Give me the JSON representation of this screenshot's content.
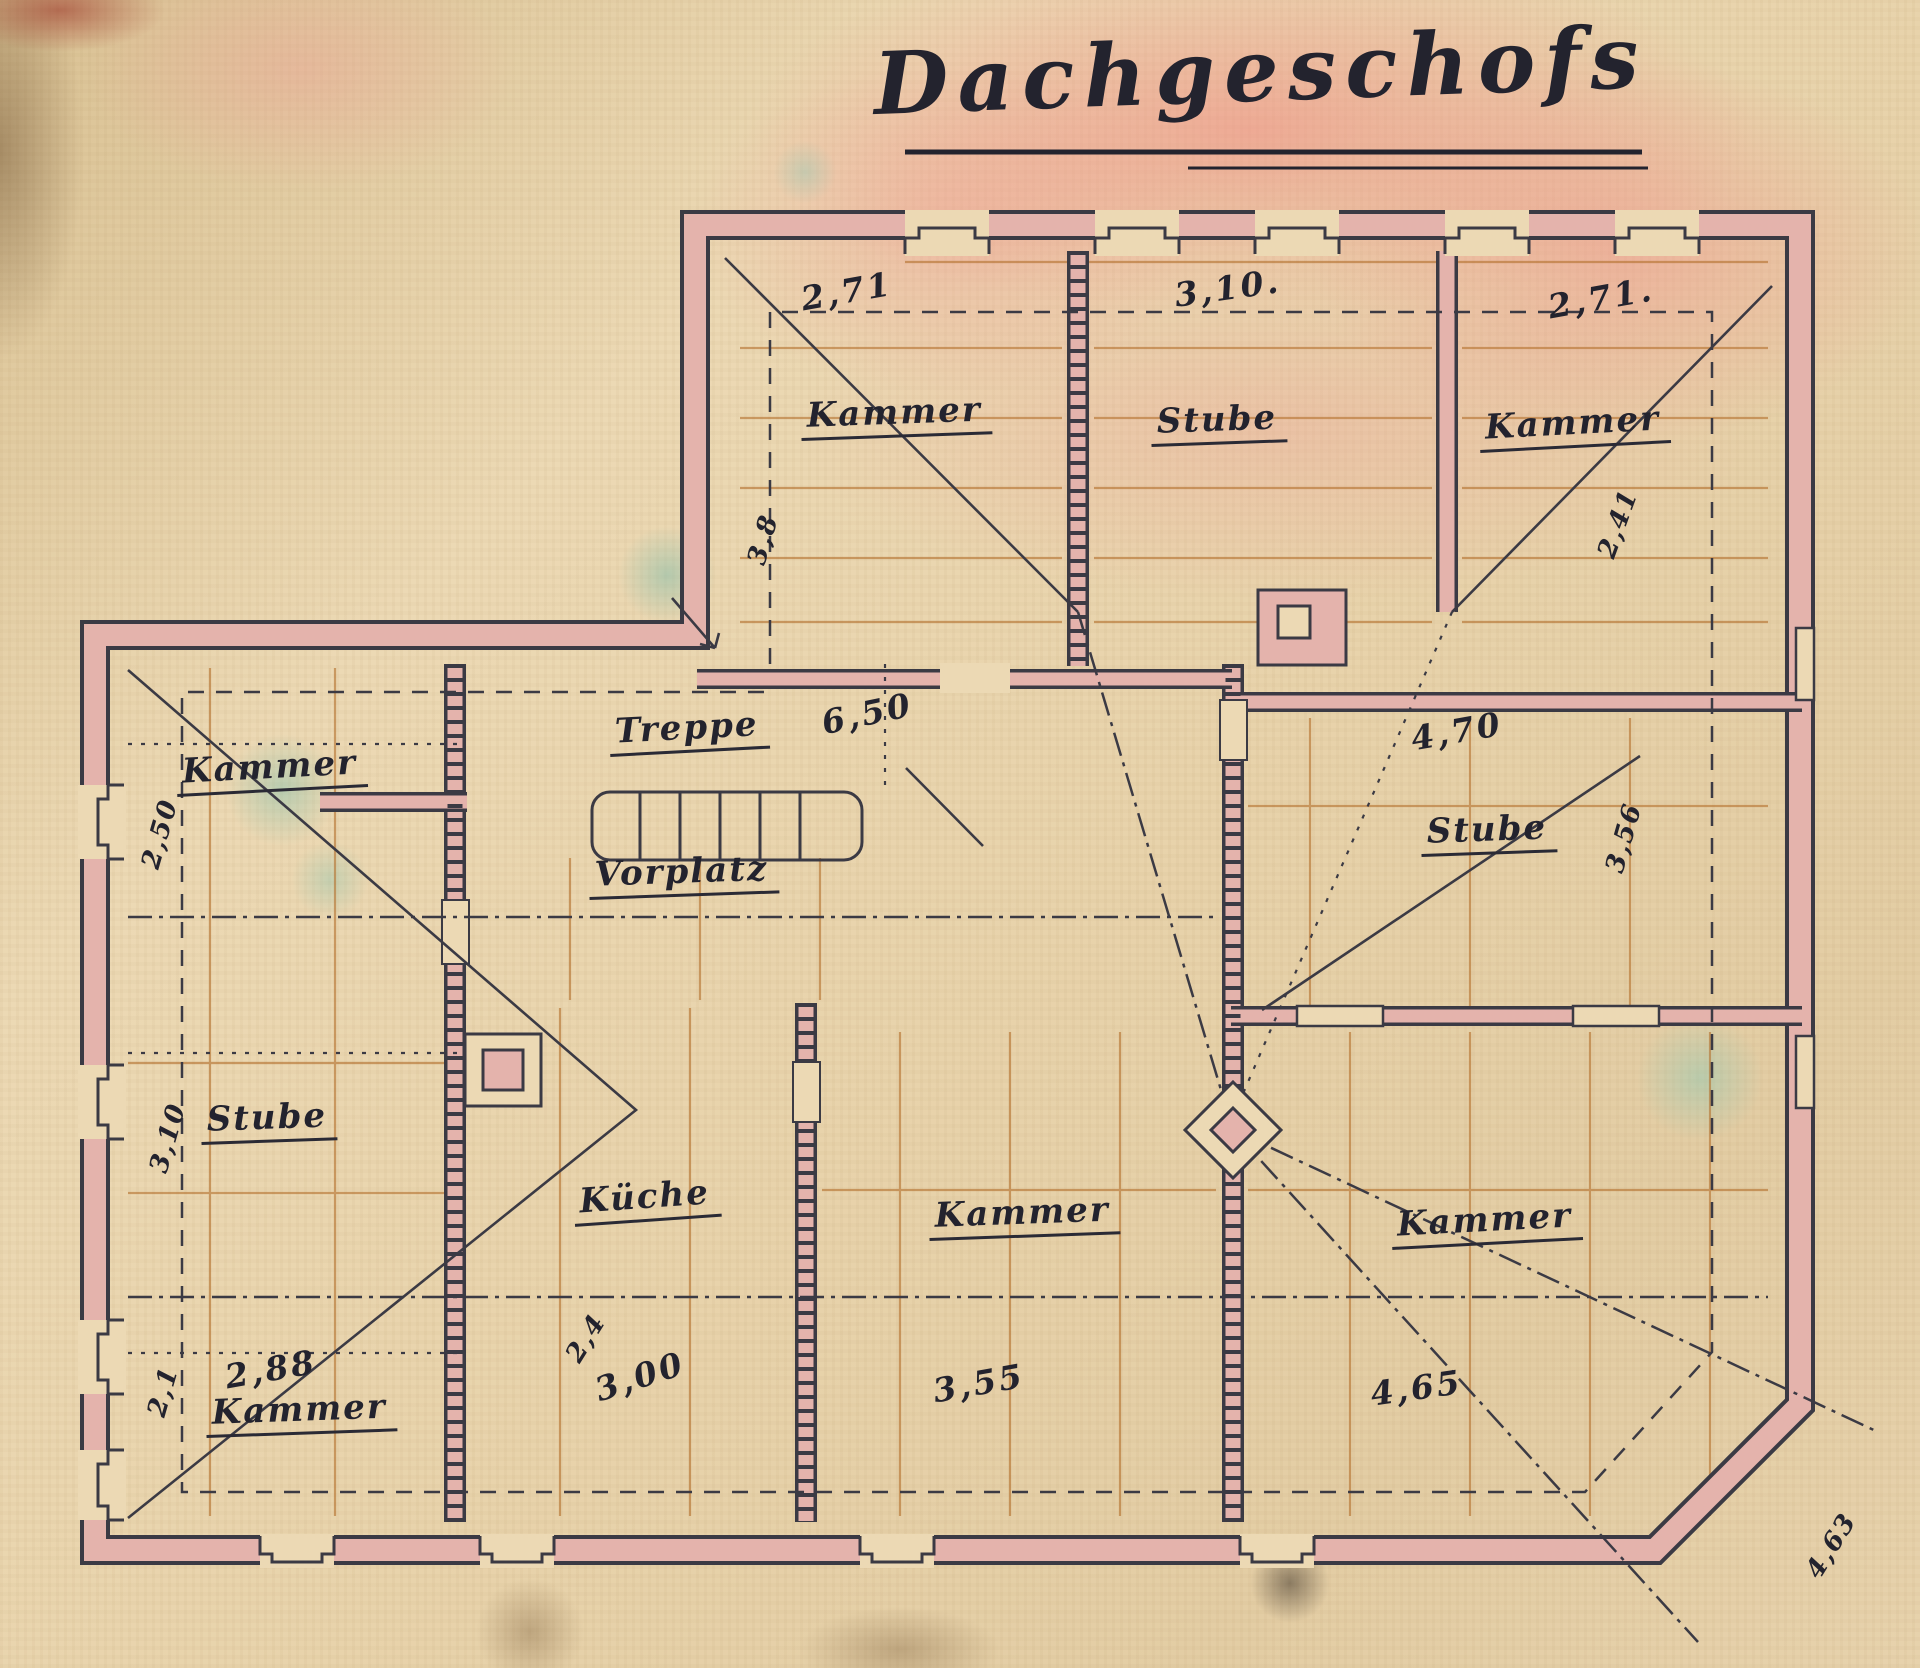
{
  "title": "Dachgeschofs",
  "rooms": {
    "upper_left": {
      "name": "Kammer",
      "width": "2,71",
      "depth": "3,8"
    },
    "upper_middle": {
      "name": "Stube",
      "width": "3,10."
    },
    "upper_right": {
      "name": "Kammer",
      "width": "2,71.",
      "depth": "2,41"
    },
    "right_stube": {
      "name": "Stube",
      "width": "4,70",
      "depth": "3,56"
    },
    "stair_hall": {
      "name": "Treppe",
      "length": "6,50"
    },
    "vorplatz": {
      "name": "Vorplatz"
    },
    "left_kammer_top": {
      "name": "Kammer",
      "depth": "2,50"
    },
    "left_stube": {
      "name": "Stube",
      "depth": "3,10"
    },
    "left_kammer_bottom": {
      "name": "Kammer",
      "width": "2,88",
      "depth": "2,1"
    },
    "kueche": {
      "name": "Küche",
      "width": "3,00",
      "diagonal": "2,4"
    },
    "middle_kammer": {
      "name": "Kammer",
      "width": "3,55"
    },
    "right_kammer": {
      "name": "Kammer",
      "width": "4,65",
      "diagonal": "4,63"
    }
  },
  "colors": {
    "paper": "#e8d4ae",
    "ink": "#23232e",
    "wall_fill": "#e4b3ac",
    "beam_line": "#b5722f",
    "wash_pink": "#efa49a",
    "wash_teal": "#8fc0ab"
  }
}
